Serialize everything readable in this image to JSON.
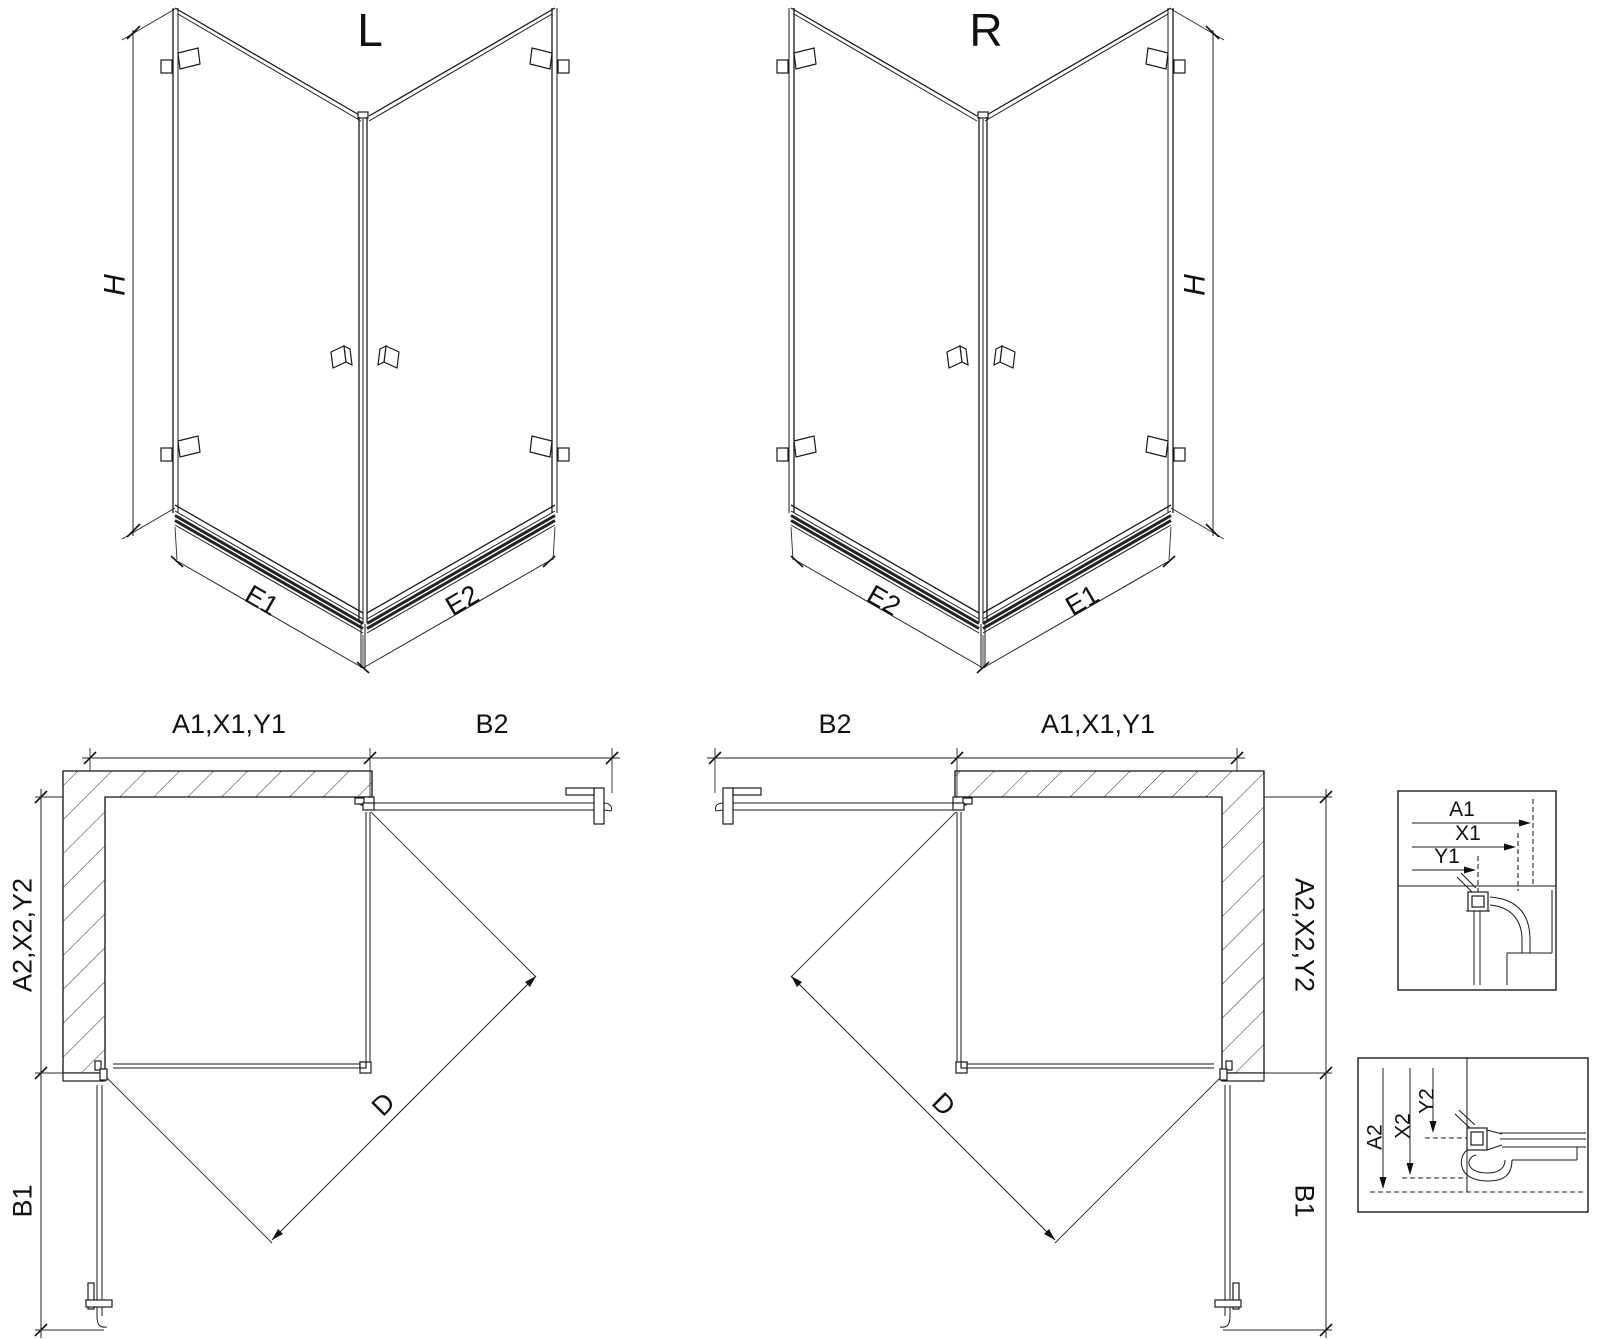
{
  "diagram": {
    "iso_left": {
      "title": "L",
      "height_label": "H",
      "base_left_label": "E1",
      "base_right_label": "E2"
    },
    "iso_right": {
      "title": "R",
      "height_label": "H",
      "base_left_label": "E2",
      "base_right_label": "E1"
    },
    "plan_left": {
      "top_label": "A1,X1,Y1",
      "top_right_label": "B2",
      "left_label": "A2,X2,Y2",
      "bottom_left_label": "B1",
      "diagonal_label": "D"
    },
    "plan_right": {
      "top_left_label": "B2",
      "top_label": "A1,X1,Y1",
      "right_label": "A2,X2,Y2",
      "bottom_right_label": "B1",
      "diagonal_label": "D"
    },
    "detail_top": {
      "dim1": "A1",
      "dim2": "X1",
      "dim3": "Y1"
    },
    "detail_bottom": {
      "dim1": "A2",
      "dim2": "X2",
      "dim3": "Y2"
    }
  }
}
